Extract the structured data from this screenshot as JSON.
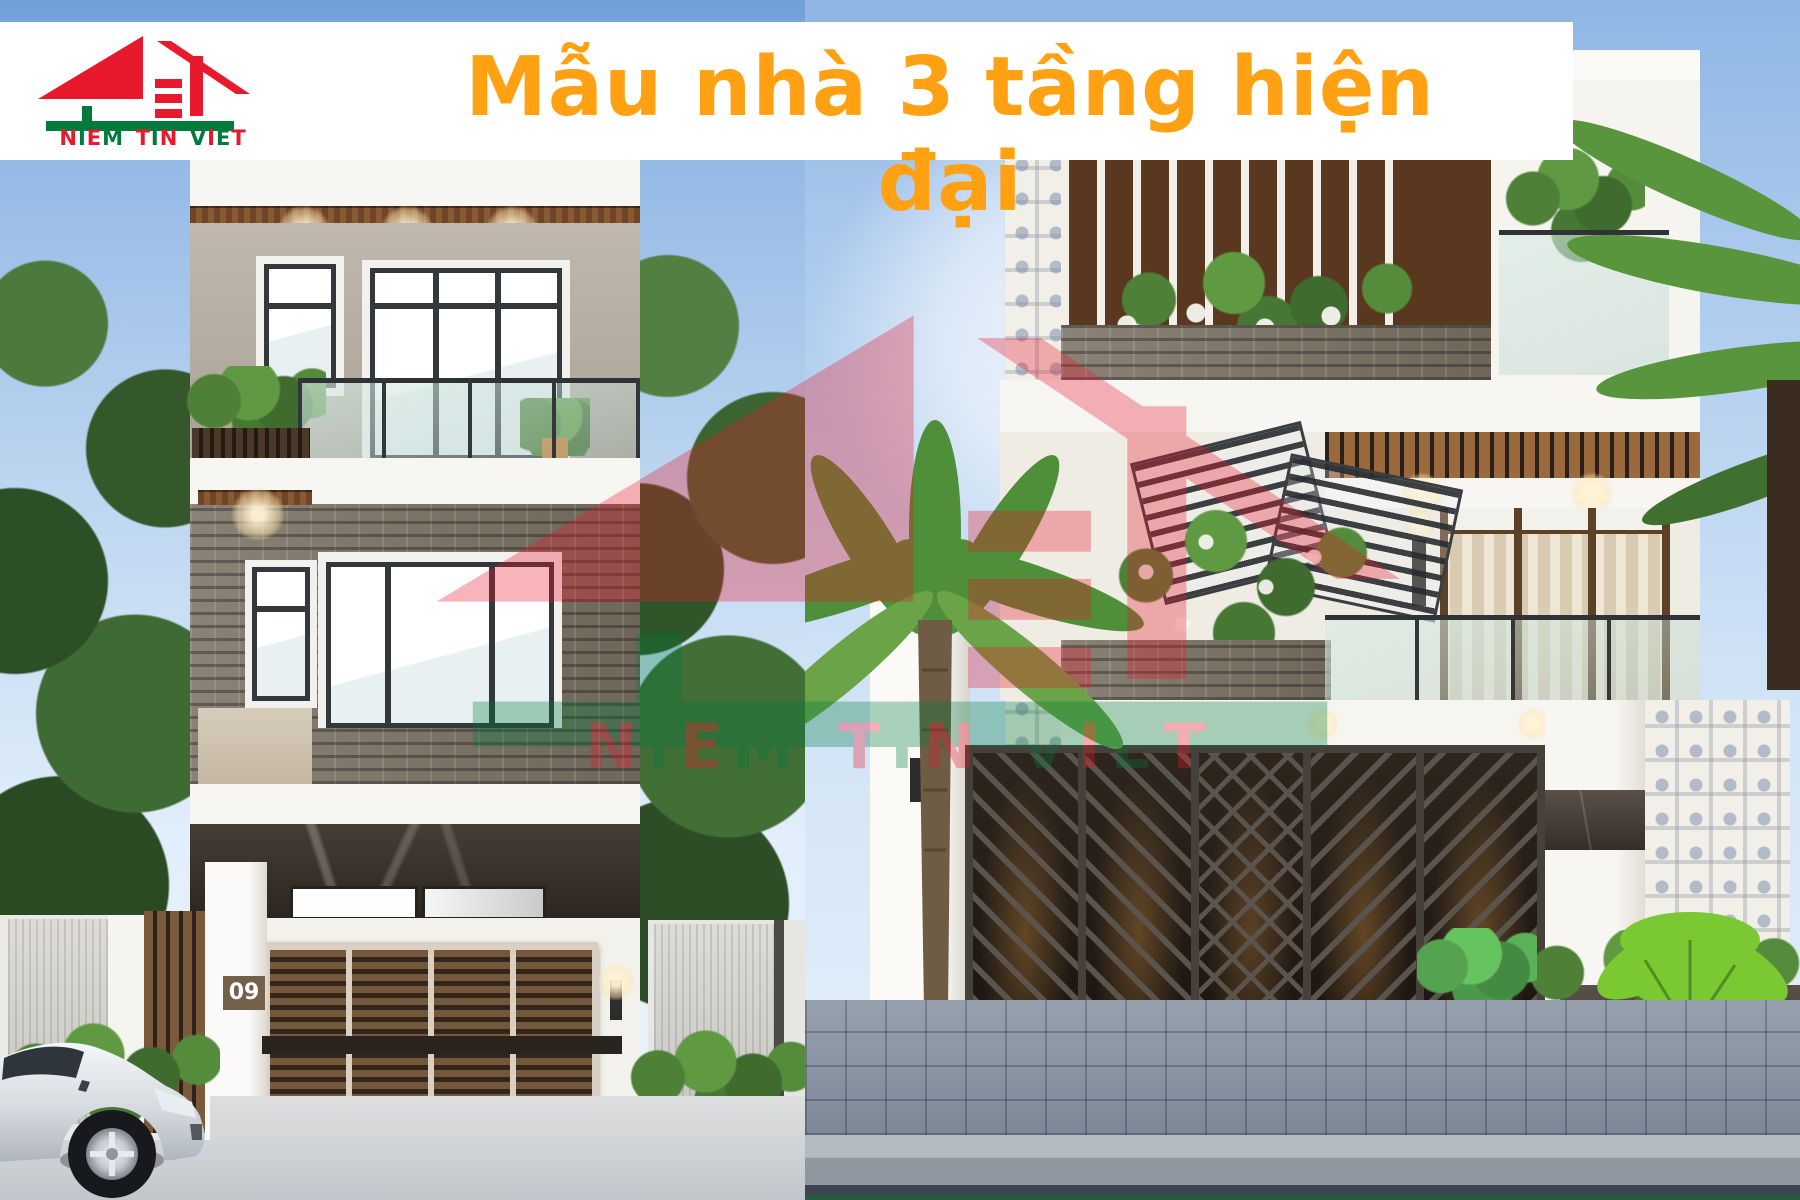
{
  "banner": {
    "title": "Mẫu nhà 3 tầng hiện đại"
  },
  "logo": {
    "name": "NIEM TIN VIET",
    "letters": [
      {
        "ch": "N",
        "color": "#E8192C"
      },
      {
        "ch": "I",
        "color": "#007B3E"
      },
      {
        "ch": "E",
        "color": "#E8192C"
      },
      {
        "ch": "M",
        "color": "#007B3E"
      },
      {
        "ch": " "
      },
      {
        "ch": "T",
        "color": "#E8192C"
      },
      {
        "ch": "I",
        "color": "#007B3E"
      },
      {
        "ch": "N",
        "color": "#E8192C"
      },
      {
        "ch": " "
      },
      {
        "ch": "V",
        "color": "#007B3E"
      },
      {
        "ch": "I",
        "color": "#E8192C"
      },
      {
        "ch": "E",
        "color": "#007B3E"
      },
      {
        "ch": "T",
        "color": "#E8192C"
      }
    ]
  },
  "left_photo": {
    "house_number": "09"
  },
  "watermark": {
    "opacity": 0.32
  },
  "palette": {
    "accent": "#FFA112",
    "banner_bg": "#FFFFFF",
    "logo_red": "#E8192C",
    "logo_green": "#007B3E",
    "plate_bg": "#756149",
    "plate_text": "#FFFFFF"
  }
}
